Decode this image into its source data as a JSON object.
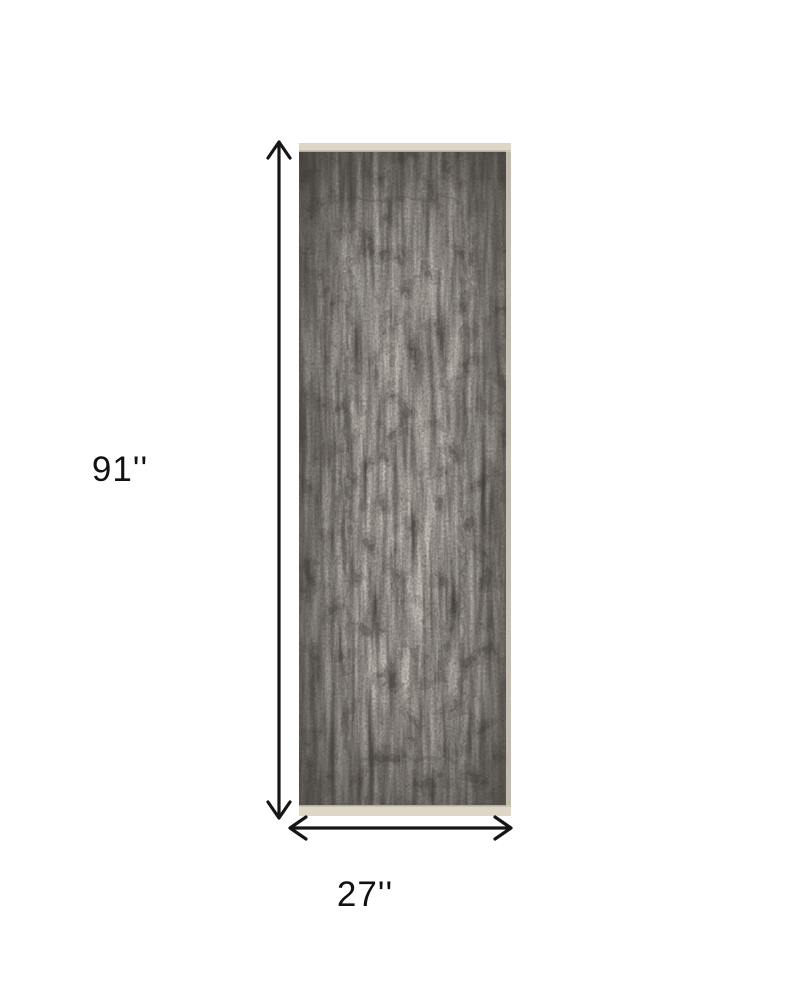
{
  "diagram": {
    "subject": "distressed gray and ivory runner rug shown flat with dimension arrows",
    "height_label": "91''",
    "width_label": "27''",
    "arrows": {
      "height": "double-headed-vertical-arrow",
      "width": "double-headed-horizontal-arrow"
    },
    "colors": {
      "background": "#ffffff",
      "arrow": "#161616",
      "label_text": "#111111",
      "rug_base": "#c8c3bb",
      "rug_dark": "#38342f",
      "rug_mid": "#756f68",
      "rug_binding": "#ded7c8"
    }
  }
}
